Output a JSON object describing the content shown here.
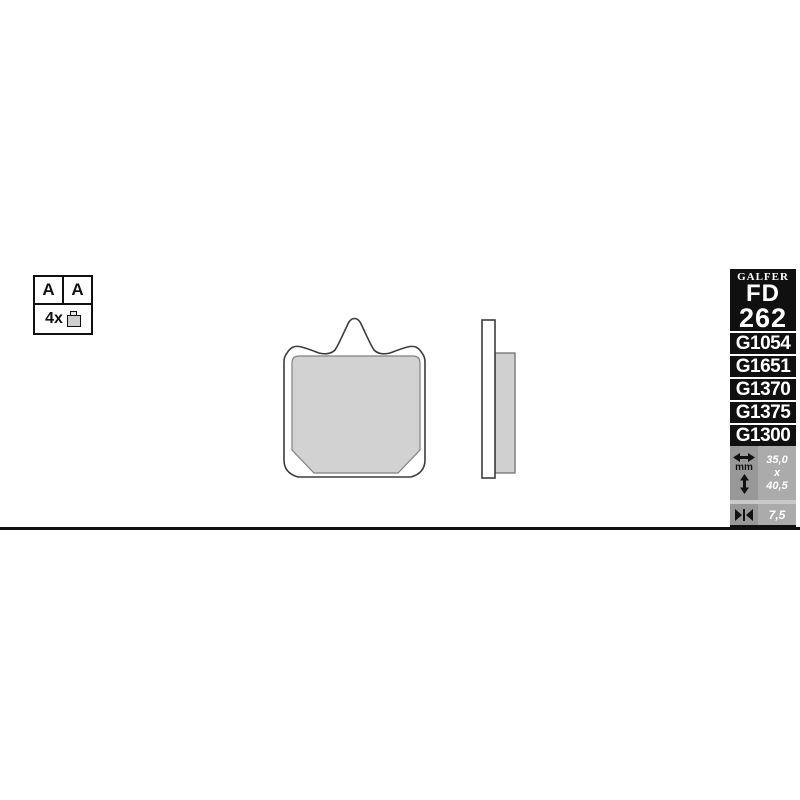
{
  "legend": {
    "front_axle": "A",
    "rear_axle": "A",
    "quantity": "4x",
    "pad_icon": "brake-pad-icon"
  },
  "sidebar": {
    "brand": "GALFER",
    "model_prefix": "FD",
    "model_number": "262",
    "compound_codes": [
      "G1054",
      "G1651",
      "G1370",
      "G1375",
      "G1300"
    ],
    "dimensions": {
      "unit": "mm",
      "width_mm": "35,0",
      "separator": "x",
      "height_mm": "40,5",
      "thickness_mm": "7,5"
    },
    "icons": {
      "width": "left-right-arrow-icon",
      "height": "up-down-arrow-icon",
      "thickness": "thickness-arrow-icon"
    },
    "colors": {
      "bg": "#101010",
      "text": "#ffffff",
      "dims_left_bg": "#989898",
      "dims_right_bg": "#ababab",
      "separator": "#c9c9c9"
    }
  },
  "drawing": {
    "description": "brake pad front view and side view",
    "pad_fill": "#d2d2d2",
    "outline": "#3c3c3c",
    "baseline_color": "#101010"
  }
}
